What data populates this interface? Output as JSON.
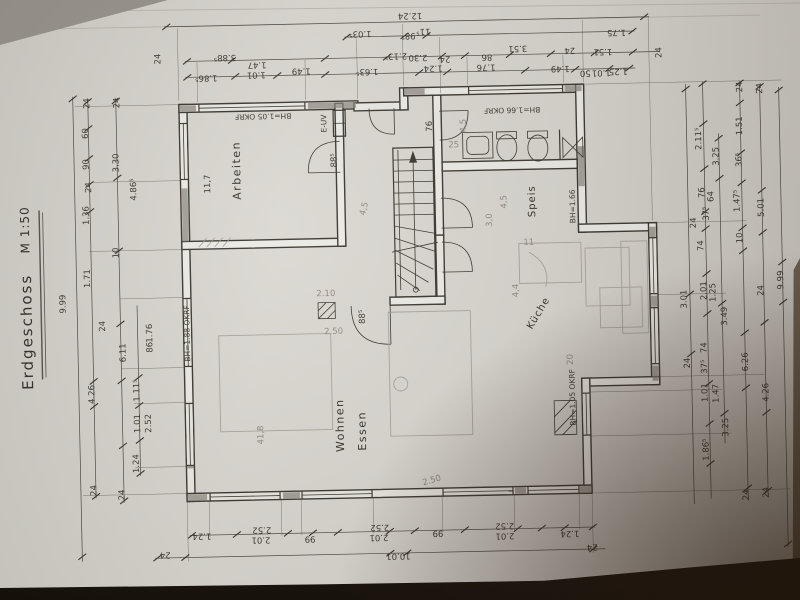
{
  "title": {
    "name": "Erdgeschoss",
    "scale": "M 1:50"
  },
  "rooms": {
    "arbeiten": {
      "name": "Arbeiten",
      "area": "11,7"
    },
    "wohnen": {
      "name": "Wohnen"
    },
    "essen": {
      "name": "Essen",
      "area": "41,8"
    },
    "speis": {
      "name": "Speis"
    },
    "kueche": {
      "name": "Küche",
      "area": "4,4"
    },
    "euv": {
      "name": "E-UV"
    }
  },
  "ann": {
    "bh_arbeiten": "BH=1.05 OKRF",
    "bh_bad": "BH=1.66 OKRF",
    "bh_wohnen": "BH=1.88 OKRF",
    "bh_kueche_wand": "BH=1.05 OKRF",
    "bh_speis": "BH=1.66",
    "door_arbeiten": "88⁵",
    "door_diele": "88⁵",
    "door_bad": "76"
  },
  "dims": {
    "top": [
      "12.24",
      "1.03⁵",
      "98⁵",
      "11⁵",
      "2.13⁵",
      "2.30",
      "1.63⁵",
      "24",
      "3.88⁵",
      "1.86⁵",
      "1.47",
      "1.01",
      "1.49",
      "24",
      "3.51",
      "86",
      "1.76",
      "1.24",
      "1.49",
      "1.75",
      "1.51",
      "24",
      "24",
      "50",
      "1.01",
      "1.25"
    ],
    "left": [
      "9.99",
      "24",
      "24",
      "60",
      "90",
      "3.30",
      "24",
      "1.36",
      "4.86⁵",
      "10",
      "1.71",
      "24",
      "1.76",
      "86",
      "6.11",
      "1.11⁵",
      "4.26",
      "1.01",
      "2.52",
      "1.24",
      "24",
      "24"
    ],
    "right": [
      "24",
      "24",
      "2.11⁵",
      "1.51",
      "3.25",
      "36⁵",
      "76",
      "64",
      "1.47⁵",
      "37⁵",
      "24",
      "5.01",
      "74",
      "10",
      "2.01",
      "1.25",
      "3.01",
      "24",
      "9.99",
      "3.49",
      "74",
      "24",
      "37⁵",
      "6.26",
      "1.01",
      "1.47",
      "3.25",
      "1.86⁵",
      "4.26",
      "24",
      "24"
    ],
    "bottom": [
      "1.24",
      "24",
      "2.52",
      "2.01",
      "99",
      "2.52",
      "2.01",
      "99",
      "2.52",
      "2.01",
      "1.24",
      "24",
      "10.01"
    ]
  },
  "pencil": {
    "stair": "4,5",
    "bad": "4,5",
    "speis": "4,5",
    "s30": "3,0",
    "k20": "20",
    "s25": "25",
    "c210": "2.10",
    "c250": "2.50",
    "e250": "2.50",
    "k11": "11"
  }
}
